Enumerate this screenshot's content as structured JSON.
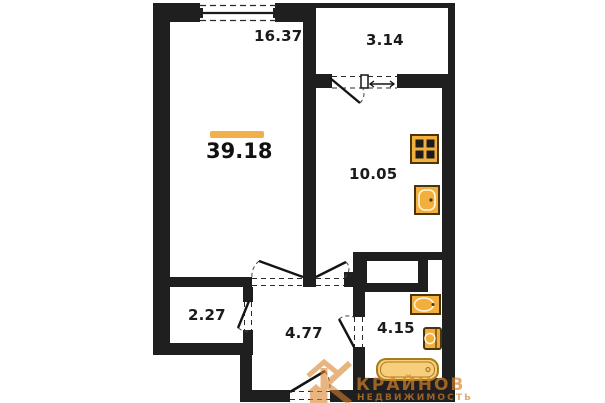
{
  "plan": {
    "total_area": {
      "value": "39.18"
    },
    "rooms": [
      {
        "id": "living-room",
        "area": "16.37"
      },
      {
        "id": "balcony",
        "area": "3.14"
      },
      {
        "id": "kitchen",
        "area": "10.05"
      },
      {
        "id": "closet",
        "area": "2.27"
      },
      {
        "id": "hallway",
        "area": "4.77"
      },
      {
        "id": "bathroom",
        "area": "4.15"
      }
    ],
    "fixtures": [
      "stove-icon",
      "kitchen-sink-icon",
      "bath-sink-icon",
      "toilet-icon",
      "bathtub-icon"
    ],
    "colors": {
      "wall": "#1F1F1F",
      "text": "#1B1B1B",
      "accent": "#F2B04A",
      "fixture": "#F3AF3D",
      "fixture_border": "#7A5A10",
      "fixture_light": "#F7CE7B",
      "tub_border": "#A87C1E",
      "watermark": "#D9822B"
    }
  },
  "watermark": {
    "brand": "КРАЙНОВ",
    "subtitle": "НЕДВИЖИМОСТЬ"
  }
}
